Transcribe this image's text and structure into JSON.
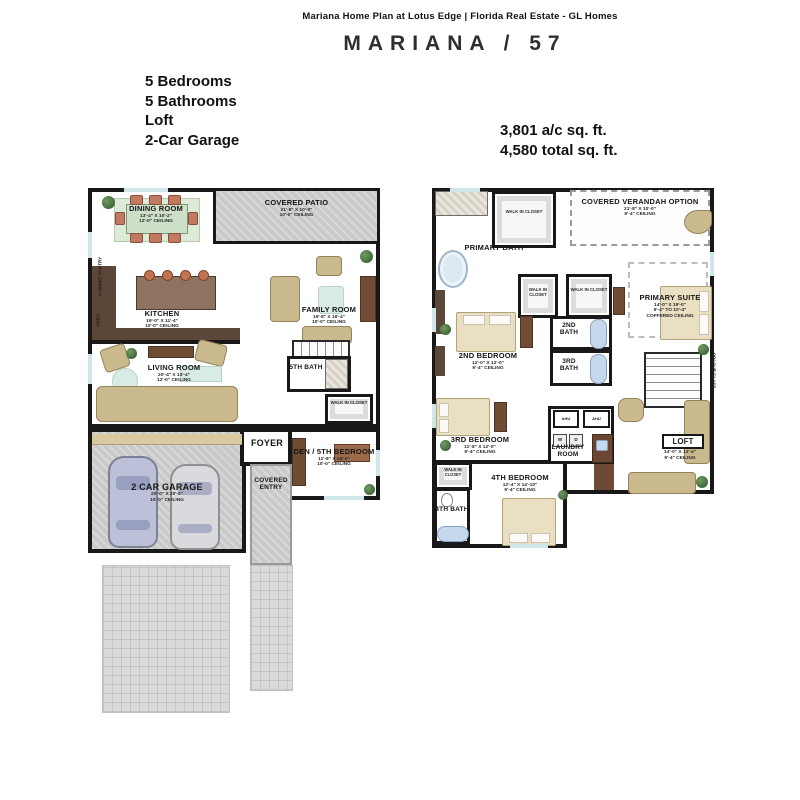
{
  "header": {
    "site_line": "Mariana Home Plan at Lotus Edge | Florida Real Estate - GL Homes",
    "plan_title": "MARIANA / 57"
  },
  "features": {
    "bedrooms": "5 Bedrooms",
    "bathrooms": "5 Bathrooms",
    "loft": "Loft",
    "garage": "2-Car Garage"
  },
  "area_stats": {
    "ac": "3,801 a/c sq. ft.",
    "total": "4,580 total sq. ft."
  },
  "first_floor": {
    "dining_room": {
      "name": "DINING ROOM",
      "dims": "13'-4\" X 10'-2\"",
      "ceiling": "12'-0\" CEILING"
    },
    "covered_patio": {
      "name": "COVERED PATIO",
      "dims": "21'-8\" X 10'-0\"",
      "ceiling": "10'-0\" CEILING"
    },
    "kitchen": {
      "name": "KITCHEN",
      "dims": "19'-0\" X 11'-4\"",
      "ceiling": "10'-0\" CEILING"
    },
    "family_room": {
      "name": "FAMILY ROOM",
      "dims": "19'-8\" X 16'-4\"",
      "ceiling": "10'-0\" CEILING"
    },
    "living_room": {
      "name": "LIVING ROOM",
      "dims": "20'-4\" X 13'-4\"",
      "ceiling": "12'-0\" CEILING"
    },
    "fifth_bath": {
      "name": "5TH BATH"
    },
    "walk_in_closet": {
      "name": "WALK IN CLOSET"
    },
    "foyer": {
      "name": "FOYER"
    },
    "den": {
      "name": "DEN / 5TH BEDROOM",
      "dims": "11'-8\" X 14'-0\"",
      "ceiling": "10'-0\" CEILING"
    },
    "garage": {
      "name": "2 CAR GARAGE",
      "dims": "20'-0\" X 20'-0\"",
      "ceiling": "10'-0\" CEILING"
    },
    "covered_entry": {
      "name": "COVERED ENTRY"
    },
    "pantry": "CABINET PANTRY",
    "oven": "OVEN"
  },
  "second_floor": {
    "primary_bath": {
      "name": "PRIMARY BATH"
    },
    "wic_top": {
      "name": "WALK IN CLOSET"
    },
    "verandah": {
      "name": "COVERED VERANDAH OPTION",
      "dims": "21'-8\" X 10'-0\"",
      "ceiling": "9'-4\" CEILING"
    },
    "primary_suite": {
      "name": "PRIMARY SUITE",
      "dims": "14'-0\" X 19'-0\"",
      "ceiling": "9'-4\" TO 10'-4\"",
      "ceiling2": "COFFERED CEILING"
    },
    "wic_mid_left": {
      "name": "WALK IN CLOSET"
    },
    "wic_mid_right": {
      "name": "WALK IN CLOSET"
    },
    "second_bedroom": {
      "name": "2ND BEDROOM",
      "dims": "12'-0\" X 12'-0\"",
      "ceiling": "9'-4\" CEILING"
    },
    "second_bath": {
      "name": "2ND BATH"
    },
    "third_bath": {
      "name": "3RD BATH"
    },
    "third_bedroom": {
      "name": "3RD BEDROOM",
      "dims": "11'-8\" X 12'-0\"",
      "ceiling": "9'-4\" CEILING"
    },
    "laundry_room": {
      "name": "LAUNDRY ROOM"
    },
    "loft": {
      "name": "LOFT",
      "dims": "14'-0\" X 13'-4\"",
      "ceiling": "9'-4\" CEILING"
    },
    "wic_bottom": {
      "name": "WALK IN CLOSET"
    },
    "fourth_bedroom": {
      "name": "4TH BEDROOM",
      "dims": "12'-4\" X 14'-10\"",
      "ceiling": "9'-4\" CEILING"
    },
    "fourth_bath": {
      "name": "4TH BATH"
    },
    "opaque_glass": "OPAQUE GLASS",
    "ahu": "AHU",
    "washer": "W",
    "dryer": "D"
  },
  "colors": {
    "wall": "#181818",
    "hardscape_gray": "#c9c9c9",
    "furniture_tan": "#c9b98c",
    "wood_brown": "#714c35",
    "water_blue": "#c6d8ec",
    "rug_green": "#d9ece4"
  }
}
